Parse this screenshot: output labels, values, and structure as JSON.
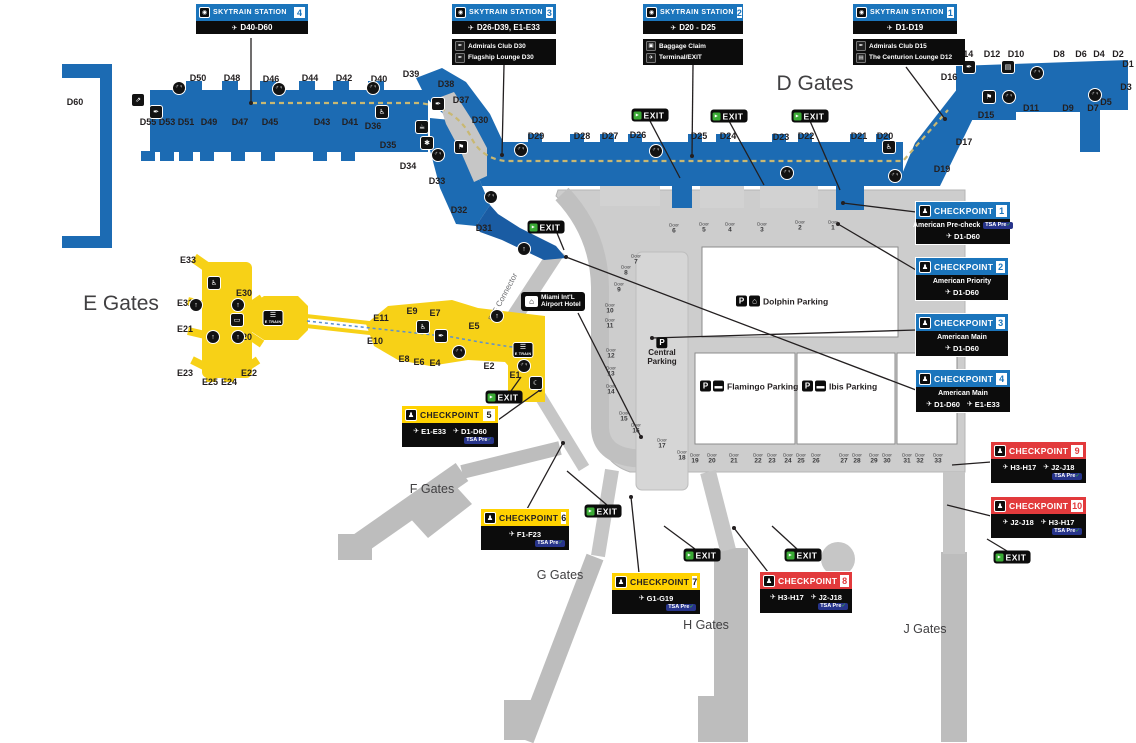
{
  "skytrain_title": "SKYTRAIN STATION",
  "exit_label": "EXIT",
  "door_word": "Door",
  "checkpoint_word": "CHECKPOINT",
  "tsa": {
    "text": "TSA Pre",
    "check": "✓"
  },
  "colors": {
    "d_blue": "#1c6bb3",
    "e_yellow": "#f7d117",
    "cp_blue": "#1b75bc",
    "cp_yellow": "#ffd200",
    "cp_red": "#e23a3c",
    "exit_green": "#3aaa35",
    "terminal_gray": "#cdcdcd",
    "skytrain_dash_tan": "#c9b872"
  },
  "icon_glyphs": {
    "skytrain": "◉",
    "airplane": "✈",
    "restroom": "♂♀",
    "wheelchair": "♿",
    "escalator": "⇗",
    "lounge": "✒",
    "flag": "⚑",
    "sign": "▤",
    "coffee": "☕",
    "pet": "✱",
    "elevator": "↑",
    "transit": "▭",
    "train": "☰",
    "lounge-moon": "☾",
    "bed": "⌂",
    "parking": "P",
    "car": "▬",
    "garage": "⌂",
    "baggage": "▣",
    "person": "♟",
    "runner": "▸"
  },
  "region_titles": [
    {
      "id": "d-gates",
      "text": "D Gates",
      "x": 815,
      "y": 84,
      "size": 21
    },
    {
      "id": "e-gates",
      "text": "E Gates",
      "x": 121,
      "y": 304,
      "size": 21
    },
    {
      "id": "f-gates",
      "text": "F Gates",
      "x": 432,
      "y": 489,
      "size": 12.5
    },
    {
      "id": "g-gates",
      "text": "G Gates",
      "x": 560,
      "y": 575,
      "size": 12.5
    },
    {
      "id": "h-gates",
      "text": "H Gates",
      "x": 706,
      "y": 625,
      "size": 12.5
    },
    {
      "id": "j-gates",
      "text": "J Gates",
      "x": 925,
      "y": 629,
      "size": 12.5
    }
  ],
  "skytrain_stations": [
    {
      "number": "4",
      "x": 196,
      "y": 4,
      "w": 112,
      "gates": "D40-D60",
      "extras": []
    },
    {
      "number": "3",
      "x": 452,
      "y": 4,
      "w": 104,
      "gates": "D26-D39, E1-E33",
      "extras": [
        {
          "icon": "lounge",
          "text": "Admirals Club D30"
        },
        {
          "icon": "lounge",
          "text": "Flagship Lounge D30"
        }
      ]
    },
    {
      "number": "2",
      "x": 643,
      "y": 4,
      "w": 100,
      "gates": "D20 - D25",
      "extras": [
        {
          "icon": "baggage",
          "text": "Baggage Claim"
        },
        {
          "icon": "airplane",
          "text": "Terminal/EXIT"
        }
      ]
    },
    {
      "number": "1",
      "x": 853,
      "y": 4,
      "w": 104,
      "extras_w": 112,
      "gates": "D1-D19",
      "extras": [
        {
          "icon": "lounge",
          "text": "Admirals Club D15"
        },
        {
          "icon": "sign",
          "text": "The Centurion Lounge D12"
        }
      ]
    }
  ],
  "checkpoints": [
    {
      "number": "1",
      "color": "blue",
      "x": 916,
      "y": 202,
      "w": 94,
      "name": "American Pre-check",
      "name_tsa": true,
      "gates": [
        "D1-D60"
      ],
      "tsa": false
    },
    {
      "number": "2",
      "color": "blue",
      "x": 916,
      "y": 258,
      "w": 92,
      "name": "American Priority",
      "name_tsa": false,
      "gates": [
        "D1-D60"
      ],
      "tsa": false
    },
    {
      "number": "3",
      "color": "blue",
      "x": 916,
      "y": 314,
      "w": 92,
      "name": "American Main",
      "name_tsa": false,
      "gates": [
        "D1-D60"
      ],
      "tsa": false
    },
    {
      "number": "4",
      "color": "blue",
      "x": 916,
      "y": 370,
      "w": 94,
      "name": "American Main",
      "name_tsa": false,
      "gates": [
        "D1-D60",
        "E1-E33"
      ],
      "tsa": false
    },
    {
      "number": "5",
      "color": "yellow",
      "x": 402,
      "y": 406,
      "w": 96,
      "gates": [
        "E1-E33",
        "D1-D60"
      ],
      "tsa": true
    },
    {
      "number": "6",
      "color": "yellow",
      "x": 481,
      "y": 509,
      "w": 88,
      "gates": [
        "F1-F23"
      ],
      "tsa": true
    },
    {
      "number": "7",
      "color": "yellow",
      "x": 612,
      "y": 573,
      "w": 88,
      "gates": [
        "G1-G19"
      ],
      "tsa": true
    },
    {
      "number": "8",
      "color": "red",
      "x": 760,
      "y": 572,
      "w": 92,
      "gates": [
        "H3-H17",
        "J2-J18"
      ],
      "tsa": true
    },
    {
      "number": "9",
      "color": "red",
      "x": 991,
      "y": 442,
      "w": 95,
      "gates": [
        "H3-H17",
        "J2-J18"
      ],
      "tsa": true
    },
    {
      "number": "10",
      "color": "red",
      "x": 991,
      "y": 497,
      "w": 95,
      "gates": [
        "J2-J18",
        "H3-H17"
      ],
      "tsa": true
    }
  ],
  "gate_labels": [
    {
      "text": "D60",
      "x": 75,
      "y": 102
    },
    {
      "text": "D50",
      "x": 198,
      "y": 78
    },
    {
      "text": "D48",
      "x": 232,
      "y": 78
    },
    {
      "text": "D46",
      "x": 271,
      "y": 79
    },
    {
      "text": "D44",
      "x": 310,
      "y": 78
    },
    {
      "text": "D42",
      "x": 344,
      "y": 78
    },
    {
      "text": "D40",
      "x": 379,
      "y": 79
    },
    {
      "text": "D39",
      "x": 411,
      "y": 74
    },
    {
      "text": "D38",
      "x": 446,
      "y": 84
    },
    {
      "text": "D37",
      "x": 461,
      "y": 100
    },
    {
      "text": "D30",
      "x": 480,
      "y": 120
    },
    {
      "text": "D55",
      "x": 148,
      "y": 122
    },
    {
      "text": "D53",
      "x": 167,
      "y": 122
    },
    {
      "text": "D51",
      "x": 186,
      "y": 122
    },
    {
      "text": "D49",
      "x": 209,
      "y": 122
    },
    {
      "text": "D47",
      "x": 240,
      "y": 122
    },
    {
      "text": "D45",
      "x": 270,
      "y": 122
    },
    {
      "text": "D43",
      "x": 322,
      "y": 122
    },
    {
      "text": "D41",
      "x": 350,
      "y": 122
    },
    {
      "text": "D36",
      "x": 373,
      "y": 126
    },
    {
      "text": "D35",
      "x": 388,
      "y": 145
    },
    {
      "text": "D34",
      "x": 408,
      "y": 166
    },
    {
      "text": "D33",
      "x": 437,
      "y": 181
    },
    {
      "text": "D32",
      "x": 459,
      "y": 210
    },
    {
      "text": "D31",
      "x": 484,
      "y": 228
    },
    {
      "text": "D29",
      "x": 536,
      "y": 136
    },
    {
      "text": "D28",
      "x": 582,
      "y": 136
    },
    {
      "text": "D27",
      "x": 610,
      "y": 136
    },
    {
      "text": "D26",
      "x": 638,
      "y": 135
    },
    {
      "text": "D25",
      "x": 699,
      "y": 136
    },
    {
      "text": "D24",
      "x": 728,
      "y": 136
    },
    {
      "text": "D23",
      "x": 781,
      "y": 137
    },
    {
      "text": "D22",
      "x": 806,
      "y": 136
    },
    {
      "text": "D21",
      "x": 859,
      "y": 136
    },
    {
      "text": "D20",
      "x": 885,
      "y": 136
    },
    {
      "text": "D19",
      "x": 942,
      "y": 169
    },
    {
      "text": "D17",
      "x": 964,
      "y": 142
    },
    {
      "text": "D15",
      "x": 986,
      "y": 115
    },
    {
      "text": "D16",
      "x": 949,
      "y": 77
    },
    {
      "text": "D14",
      "x": 965,
      "y": 54
    },
    {
      "text": "D12",
      "x": 992,
      "y": 54
    },
    {
      "text": "D10",
      "x": 1016,
      "y": 54
    },
    {
      "text": "D8",
      "x": 1059,
      "y": 54
    },
    {
      "text": "D6",
      "x": 1081,
      "y": 54
    },
    {
      "text": "D4",
      "x": 1099,
      "y": 54
    },
    {
      "text": "D2",
      "x": 1118,
      "y": 54
    },
    {
      "text": "D1",
      "x": 1128,
      "y": 64
    },
    {
      "text": "D3",
      "x": 1126,
      "y": 87
    },
    {
      "text": "D5",
      "x": 1106,
      "y": 102
    },
    {
      "text": "D7",
      "x": 1093,
      "y": 108
    },
    {
      "text": "D9",
      "x": 1068,
      "y": 108
    },
    {
      "text": "D11",
      "x": 1031,
      "y": 108
    },
    {
      "text": "E33",
      "x": 188,
      "y": 260
    },
    {
      "text": "E31",
      "x": 185,
      "y": 303
    },
    {
      "text": "E30",
      "x": 244,
      "y": 293
    },
    {
      "text": "E21",
      "x": 185,
      "y": 329
    },
    {
      "text": "E20",
      "x": 244,
      "y": 337
    },
    {
      "text": "E23",
      "x": 185,
      "y": 373
    },
    {
      "text": "E25",
      "x": 210,
      "y": 382
    },
    {
      "text": "E24",
      "x": 229,
      "y": 382
    },
    {
      "text": "E22",
      "x": 249,
      "y": 373
    },
    {
      "text": "E11",
      "x": 381,
      "y": 318
    },
    {
      "text": "E10",
      "x": 375,
      "y": 341
    },
    {
      "text": "E9",
      "x": 412,
      "y": 311
    },
    {
      "text": "E7",
      "x": 435,
      "y": 313
    },
    {
      "text": "E5",
      "x": 474,
      "y": 326
    },
    {
      "text": "E8",
      "x": 404,
      "y": 359
    },
    {
      "text": "E6",
      "x": 419,
      "y": 362
    },
    {
      "text": "E4",
      "x": 435,
      "y": 363
    },
    {
      "text": "E2",
      "x": 489,
      "y": 366
    },
    {
      "text": "E1",
      "x": 515,
      "y": 375
    }
  ],
  "door_labels": [
    {
      "n": "1",
      "x": 833,
      "y": 226
    },
    {
      "n": "2",
      "x": 800,
      "y": 226
    },
    {
      "n": "3",
      "x": 762,
      "y": 228
    },
    {
      "n": "4",
      "x": 730,
      "y": 228
    },
    {
      "n": "5",
      "x": 704,
      "y": 228
    },
    {
      "n": "6",
      "x": 674,
      "y": 229
    },
    {
      "n": "7",
      "x": 636,
      "y": 260
    },
    {
      "n": "8",
      "x": 626,
      "y": 271
    },
    {
      "n": "9",
      "x": 619,
      "y": 288
    },
    {
      "n": "10",
      "x": 610,
      "y": 309
    },
    {
      "n": "11",
      "x": 610,
      "y": 324
    },
    {
      "n": "12",
      "x": 611,
      "y": 354
    },
    {
      "n": "13",
      "x": 611,
      "y": 372
    },
    {
      "n": "14",
      "x": 611,
      "y": 390
    },
    {
      "n": "15",
      "x": 624,
      "y": 417
    },
    {
      "n": "16",
      "x": 636,
      "y": 429
    },
    {
      "n": "17",
      "x": 662,
      "y": 444
    },
    {
      "n": "18",
      "x": 682,
      "y": 456
    },
    {
      "n": "19",
      "x": 695,
      "y": 459
    },
    {
      "n": "20",
      "x": 712,
      "y": 459
    },
    {
      "n": "21",
      "x": 734,
      "y": 459
    },
    {
      "n": "22",
      "x": 758,
      "y": 459
    },
    {
      "n": "23",
      "x": 772,
      "y": 459
    },
    {
      "n": "24",
      "x": 788,
      "y": 459
    },
    {
      "n": "25",
      "x": 801,
      "y": 459
    },
    {
      "n": "26",
      "x": 816,
      "y": 459
    },
    {
      "n": "27",
      "x": 844,
      "y": 459
    },
    {
      "n": "28",
      "x": 857,
      "y": 459
    },
    {
      "n": "29",
      "x": 874,
      "y": 459
    },
    {
      "n": "30",
      "x": 887,
      "y": 459
    },
    {
      "n": "31",
      "x": 907,
      "y": 459
    },
    {
      "n": "32",
      "x": 920,
      "y": 459
    },
    {
      "n": "33",
      "x": 938,
      "y": 459
    }
  ],
  "exit_badges": [
    {
      "x": 546,
      "y": 227
    },
    {
      "x": 650,
      "y": 115
    },
    {
      "x": 729,
      "y": 116
    },
    {
      "x": 810,
      "y": 116
    },
    {
      "x": 504,
      "y": 397
    },
    {
      "x": 603,
      "y": 511
    },
    {
      "x": 702,
      "y": 555
    },
    {
      "x": 803,
      "y": 555
    },
    {
      "x": 1012,
      "y": 557
    }
  ],
  "icons": [
    {
      "type": "escalator",
      "x": 138,
      "y": 100
    },
    {
      "type": "lounge",
      "x": 156,
      "y": 112
    },
    {
      "type": "restroom",
      "x": 179,
      "y": 88
    },
    {
      "type": "restroom",
      "x": 279,
      "y": 89
    },
    {
      "type": "restroom",
      "x": 373,
      "y": 88
    },
    {
      "type": "wheelchair",
      "x": 382,
      "y": 112
    },
    {
      "type": "lounge",
      "x": 438,
      "y": 104
    },
    {
      "type": "coffee",
      "x": 422,
      "y": 127
    },
    {
      "type": "pet",
      "x": 427,
      "y": 143
    },
    {
      "type": "restroom",
      "x": 438,
      "y": 155
    },
    {
      "type": "flag",
      "x": 461,
      "y": 147
    },
    {
      "type": "restroom",
      "x": 491,
      "y": 197
    },
    {
      "type": "restroom",
      "x": 521,
      "y": 150
    },
    {
      "type": "restroom",
      "x": 656,
      "y": 151
    },
    {
      "type": "restroom",
      "x": 787,
      "y": 173
    },
    {
      "type": "wheelchair",
      "x": 889,
      "y": 147
    },
    {
      "type": "restroom",
      "x": 895,
      "y": 176
    },
    {
      "type": "lounge",
      "x": 969,
      "y": 67
    },
    {
      "type": "sign",
      "x": 1008,
      "y": 67
    },
    {
      "type": "restroom",
      "x": 1037,
      "y": 73
    },
    {
      "type": "flag",
      "x": 989,
      "y": 97
    },
    {
      "type": "restroom",
      "x": 1009,
      "y": 97
    },
    {
      "type": "restroom",
      "x": 1095,
      "y": 95
    },
    {
      "type": "wheelchair",
      "x": 214,
      "y": 283
    },
    {
      "type": "elevator",
      "x": 196,
      "y": 305
    },
    {
      "type": "elevator",
      "x": 238,
      "y": 305
    },
    {
      "type": "elevator",
      "x": 213,
      "y": 337
    },
    {
      "type": "elevator",
      "x": 238,
      "y": 337
    },
    {
      "type": "transit",
      "x": 237,
      "y": 320
    },
    {
      "type": "wheelchair",
      "x": 423,
      "y": 327
    },
    {
      "type": "lounge",
      "x": 441,
      "y": 336
    },
    {
      "type": "restroom",
      "x": 459,
      "y": 352
    },
    {
      "type": "restroom",
      "x": 524,
      "y": 366
    },
    {
      "type": "lounge-moon",
      "x": 536,
      "y": 383
    },
    {
      "type": "elevator",
      "x": 524,
      "y": 249
    },
    {
      "type": "elevator",
      "x": 497,
      "y": 316
    }
  ],
  "parking": [
    {
      "name": "Dolphin Parking",
      "icons": [
        "parking",
        "garage"
      ],
      "x": 736,
      "y": 301,
      "stacked": false
    },
    {
      "name": "Flamingo Parking",
      "icons": [
        "parking",
        "car"
      ],
      "x": 700,
      "y": 386,
      "stacked": false
    },
    {
      "name": "Ibis Parking",
      "icons": [
        "parking",
        "car"
      ],
      "x": 802,
      "y": 386,
      "stacked": false
    },
    {
      "name": "Central Parking",
      "icons": [
        "parking"
      ],
      "x": 662,
      "y": 352,
      "stacked": true
    }
  ],
  "hotel": {
    "line1": "Miami Int'L",
    "line2": "Airport Hotel"
  },
  "etrain_stations": [
    {
      "x": 273,
      "y": 318
    },
    {
      "x": 523,
      "y": 350
    }
  ],
  "etrain_label": "E TRAIN",
  "connector": {
    "text": "D-E Connector"
  }
}
